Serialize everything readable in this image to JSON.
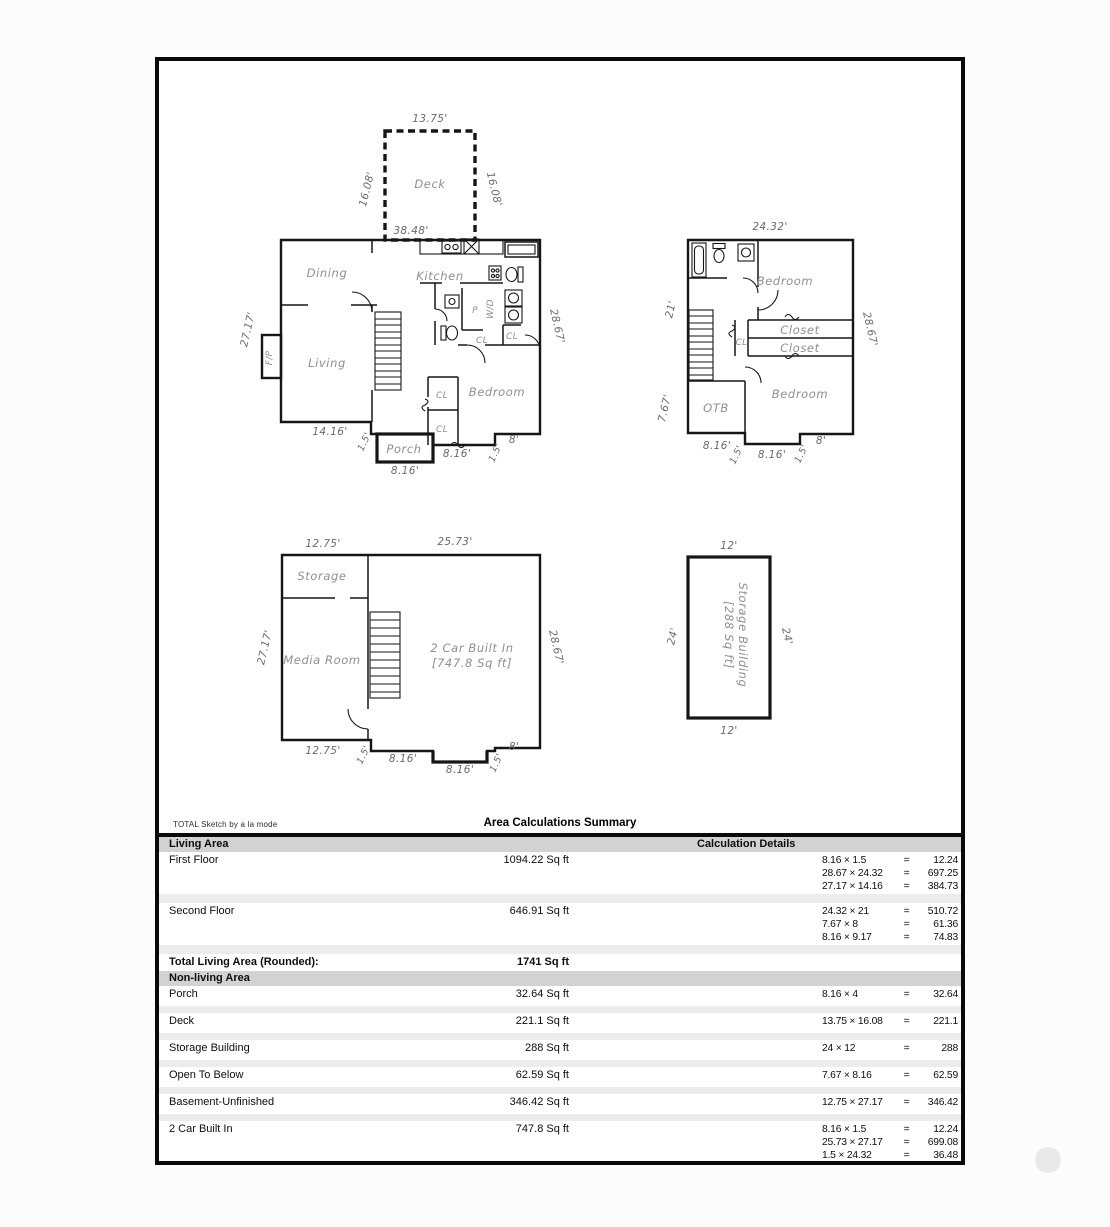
{
  "footer": {
    "brand": "TOTAL Sketch by a la mode",
    "title": "Area Calculations Summary"
  },
  "plans": {
    "first_floor": {
      "rooms": {
        "deck": "Deck",
        "dining": "Dining",
        "kitchen": "Kitchen",
        "living": "Living",
        "bedroom": "Bedroom",
        "porch": "Porch",
        "fireplace": "F/P",
        "washer_dryer": "W/D",
        "pantry": "P",
        "closet_abbr": "CL"
      },
      "dims": {
        "deck_width": "13.75'",
        "deck_side_left": "16.08'",
        "deck_side_right": "16.08'",
        "overall_width": "38.48'",
        "side_left": "27.17'",
        "side_right": "28.67'",
        "bottom_left": "14.16'",
        "step_left": "1.5'",
        "porch_width": "8.16'",
        "bottom_middle": "8.16'",
        "step_right": "1.5'",
        "bottom_right": "8'"
      }
    },
    "second_floor": {
      "rooms": {
        "bedroom_top": "Bedroom",
        "bedroom_bottom": "Bedroom",
        "closet_top": "Closet",
        "closet_bottom": "Closet",
        "closet_abbr": "CL",
        "open_to_below": "OTB"
      },
      "dims": {
        "top": "24.32'",
        "side_left_upper": "21'",
        "side_left_lower": "7.67'",
        "side_right": "28.67'",
        "bottom_left": "8.16'",
        "step_left": "1.5'",
        "bottom_middle": "8.16'",
        "step_right": "1.5'",
        "bottom_right": "8'"
      }
    },
    "basement": {
      "rooms": {
        "storage": "Storage",
        "media": "Media Room",
        "garage_line1": "2 Car Built In",
        "garage_line2": "[747.8 Sq ft]"
      },
      "dims": {
        "top_left": "12.75'",
        "top_right": "25.73'",
        "side_left": "27.17'",
        "side_right": "28.67'",
        "bottom_left": "12.75'",
        "step_left": "1.5'",
        "bottom_middle": "8.16'",
        "garage_door": "8.16'",
        "step_right": "1.5'",
        "bottom_right": "8'"
      }
    },
    "storage_building": {
      "label_line1": "Storage Building",
      "label_line2": "[288 Sq ft]",
      "dims": {
        "top": "12'",
        "bottom": "12'",
        "side_left": "24'",
        "side_right": "24'"
      }
    }
  },
  "summary": {
    "equals": "=",
    "living_header": "Living Area",
    "details_header": "Calculation Details",
    "living_rows": [
      {
        "name": "First Floor",
        "value": "1094.22 Sq ft",
        "calcs": [
          {
            "expr": "8.16 × 1.5",
            "res": "12.24"
          },
          {
            "expr": "28.67 × 24.32",
            "res": "697.25"
          },
          {
            "expr": "27.17 × 14.16",
            "res": "384.73"
          }
        ]
      },
      {
        "name": "Second Floor",
        "value": "646.91 Sq ft",
        "calcs": [
          {
            "expr": "24.32 × 21",
            "res": "510.72"
          },
          {
            "expr": "7.67 × 8",
            "res": "61.36"
          },
          {
            "expr": "8.16 × 9.17",
            "res": "74.83"
          }
        ]
      }
    ],
    "total_label": "Total Living Area (Rounded):",
    "total_value": "1741 Sq ft",
    "nonliving_header": "Non-living Area",
    "nonliving_rows": [
      {
        "name": "Porch",
        "value": "32.64 Sq ft",
        "calcs": [
          {
            "expr": "8.16 × 4",
            "res": "32.64"
          }
        ]
      },
      {
        "name": "Deck",
        "value": "221.1 Sq ft",
        "calcs": [
          {
            "expr": "13.75 × 16.08",
            "res": "221.1"
          }
        ]
      },
      {
        "name": "Storage Building",
        "value": "288 Sq ft",
        "calcs": [
          {
            "expr": "24 × 12",
            "res": "288"
          }
        ]
      },
      {
        "name": "Open To Below",
        "value": "62.59 Sq ft",
        "calcs": [
          {
            "expr": "7.67 × 8.16",
            "res": "62.59"
          }
        ]
      },
      {
        "name": "Basement-Unfinished",
        "value": "346.42 Sq ft",
        "calcs": [
          {
            "expr": "12.75 × 27.17",
            "res": "346.42"
          }
        ]
      },
      {
        "name": "2 Car Built In",
        "value": "747.8 Sq ft",
        "calcs": [
          {
            "expr": "8.16 × 1.5",
            "res": "12.24"
          },
          {
            "expr": "25.73 × 27.17",
            "res": "699.08"
          },
          {
            "expr": "1.5 × 24.32",
            "res": "36.48"
          }
        ]
      }
    ]
  }
}
